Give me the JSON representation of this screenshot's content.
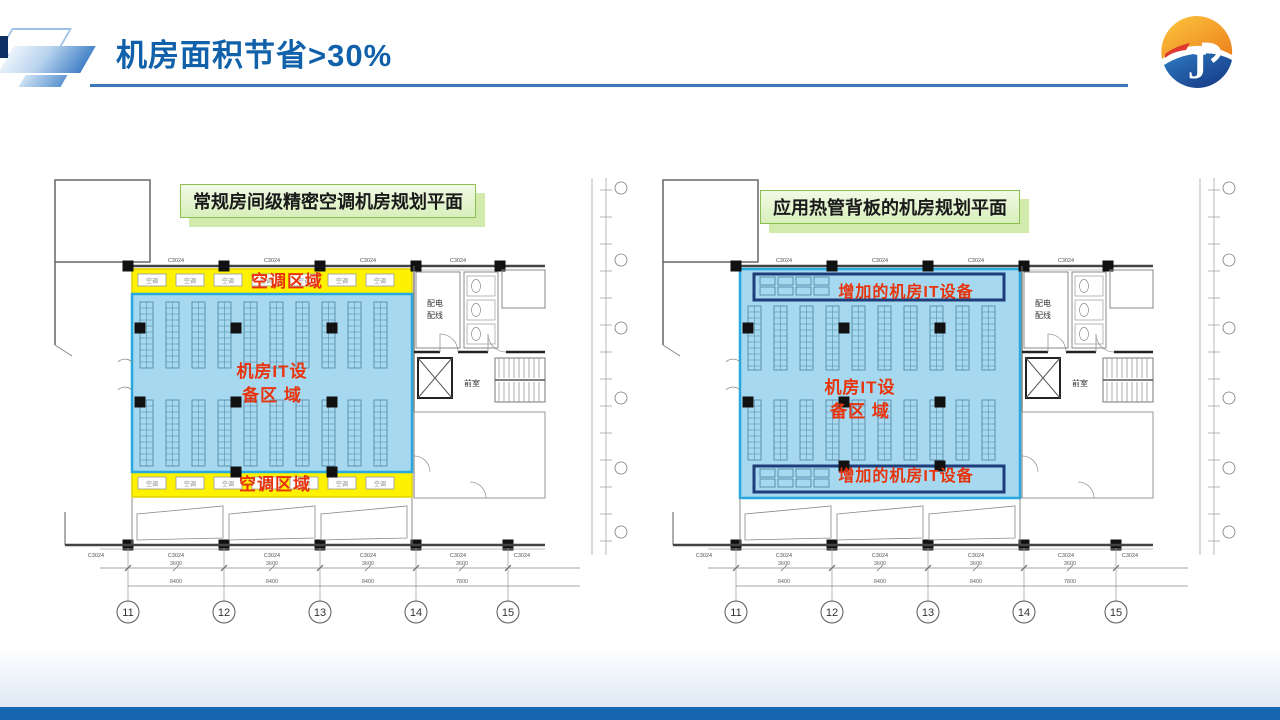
{
  "slide": {
    "title": "机房面积节省>30%"
  },
  "logo": {
    "letter": "J"
  },
  "colors": {
    "title_blue": "#1061a9",
    "header_rule": "#3c77b9",
    "footer_bar": "#1565b0",
    "green_box_border": "#8cbf52",
    "yellow_area": "#fff200",
    "yellow_border": "#e0cf00",
    "blue_area": "#a6d9ef",
    "blue_area_border": "#29a8e0",
    "dark_box_border": "#1f3d7a",
    "red_label": "#e8330c",
    "logo_orange": "#f7a21b",
    "logo_blue": "#1d4f9e"
  },
  "plans": {
    "left": {
      "header": "常规房间级精密空调机房规划平面",
      "aircon_area_top": "空调区域",
      "aircon_area_bottom": "空调区域",
      "it_area_line1": "机房IT设",
      "it_area_line2": "备区 域",
      "ac_unit": "空调"
    },
    "right": {
      "header": "应用热管背板的机房规划平面",
      "added_it_top": "增加的机房IT设备",
      "added_it_bottom": "增加的机房IT设备",
      "it_area_line1": "机房IT设",
      "it_area_line2": "备区 域"
    },
    "shared": {
      "window_label": "C3024",
      "room_power": "配电",
      "room_wiring": "配线",
      "room_lobby": "前室",
      "grid_numbers": [
        "11",
        "12",
        "13",
        "14",
        "15"
      ],
      "dim_bay": "3600",
      "dim_spans": [
        "8400",
        "8400",
        "8400",
        "7800"
      ]
    }
  }
}
